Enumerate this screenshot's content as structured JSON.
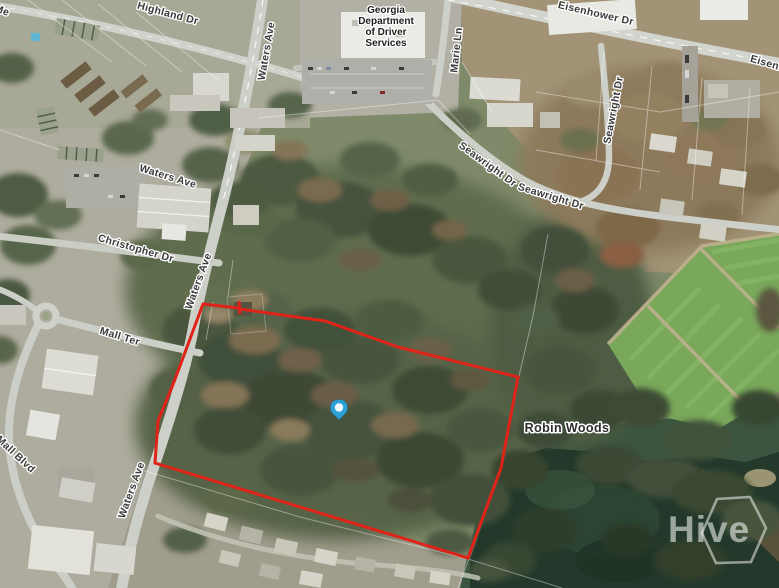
{
  "street_labels": {
    "partial_top_left": "Me",
    "highland_dr": "Highland Dr",
    "waters_ave_top": "Waters Ave",
    "waters_ave_upper_mid": "Waters Ave",
    "waters_ave_mid": "Waters Ave",
    "waters_ave_bottom": "Waters Ave",
    "marie_ln": "Marie Ln",
    "eisenhower_dr": "Eisenhower Dr",
    "eisenhower_dr_partial": "Eisenh",
    "seawright_dr_upper": "Seawright Dr",
    "seawright_dr_lower": "Seawright Dr",
    "seawright_dr_vertical": "Seawright Dr",
    "christopher_dr": "Christopher Dr",
    "mall_ter": "Mall Ter",
    "mall_blvd": "Mall Blvd"
  },
  "place_labels": {
    "poi_line1": "Georgia",
    "poi_line2": "Department",
    "poi_line3": "of Driver",
    "poi_line4": "Services",
    "neighborhood": "Robin Woods"
  },
  "marker": {
    "x": 339,
    "y": 412,
    "color": "#2DA0D6"
  },
  "boundary": {
    "color": "#E02318"
  },
  "watermark": {
    "text": "Hive"
  }
}
